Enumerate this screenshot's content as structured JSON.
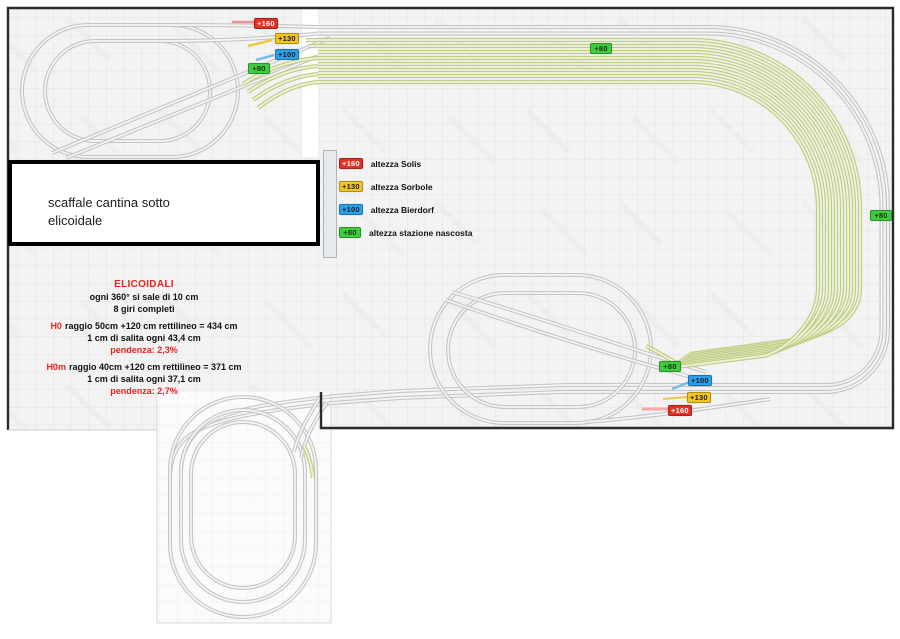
{
  "legend": {
    "items": [
      {
        "value": "+160",
        "label": "altezza Solis",
        "color": "#e63022",
        "text_color": "#ffffff"
      },
      {
        "value": "+130",
        "label": "altezza Sorbole",
        "color": "#f2c71d",
        "text_color": "#1a1a1a"
      },
      {
        "value": "+100",
        "label": "altezza Bierdorf",
        "color": "#2b9fe8",
        "text_color": "#1a1a1a"
      },
      {
        "value": "+80",
        "label": "altezza stazione nascosta",
        "color": "#3ecb3e",
        "text_color": "#1a1a1a"
      }
    ]
  },
  "height_markers": {
    "h160": "+160",
    "h130": "+130",
    "h100": "+100",
    "h80": "+80"
  },
  "note_box": {
    "line1": "scaffale cantina sotto",
    "line2": "elicoidale"
  },
  "helix_notes": {
    "title": "ELICOIDALI",
    "subtitle1": "ogni 360° si sale di 10 cm",
    "subtitle2": "8 giri completi",
    "h0_label": "H0",
    "h0_text": "raggio 50cm +120 cm rettilineo = 434 cm",
    "h0_line2": "1 cm di salita ogni 43,4 cm",
    "h0_grade": "pendenza: 2,3%",
    "h0m_label": "H0m",
    "h0m_text": "raggio 40cm +120 cm rettilineo = 371 cm",
    "h0m_line2": "1 cm di salita ogni 37,1 cm",
    "h0m_grade": "pendenza: 2,7%"
  },
  "colors": {
    "accent_red": "#e8231f",
    "track_gray": "#c6c6c6",
    "track_green": "#bfcf86",
    "board_fill": "#f3f3f3",
    "board_border": "#2b2b2b"
  }
}
